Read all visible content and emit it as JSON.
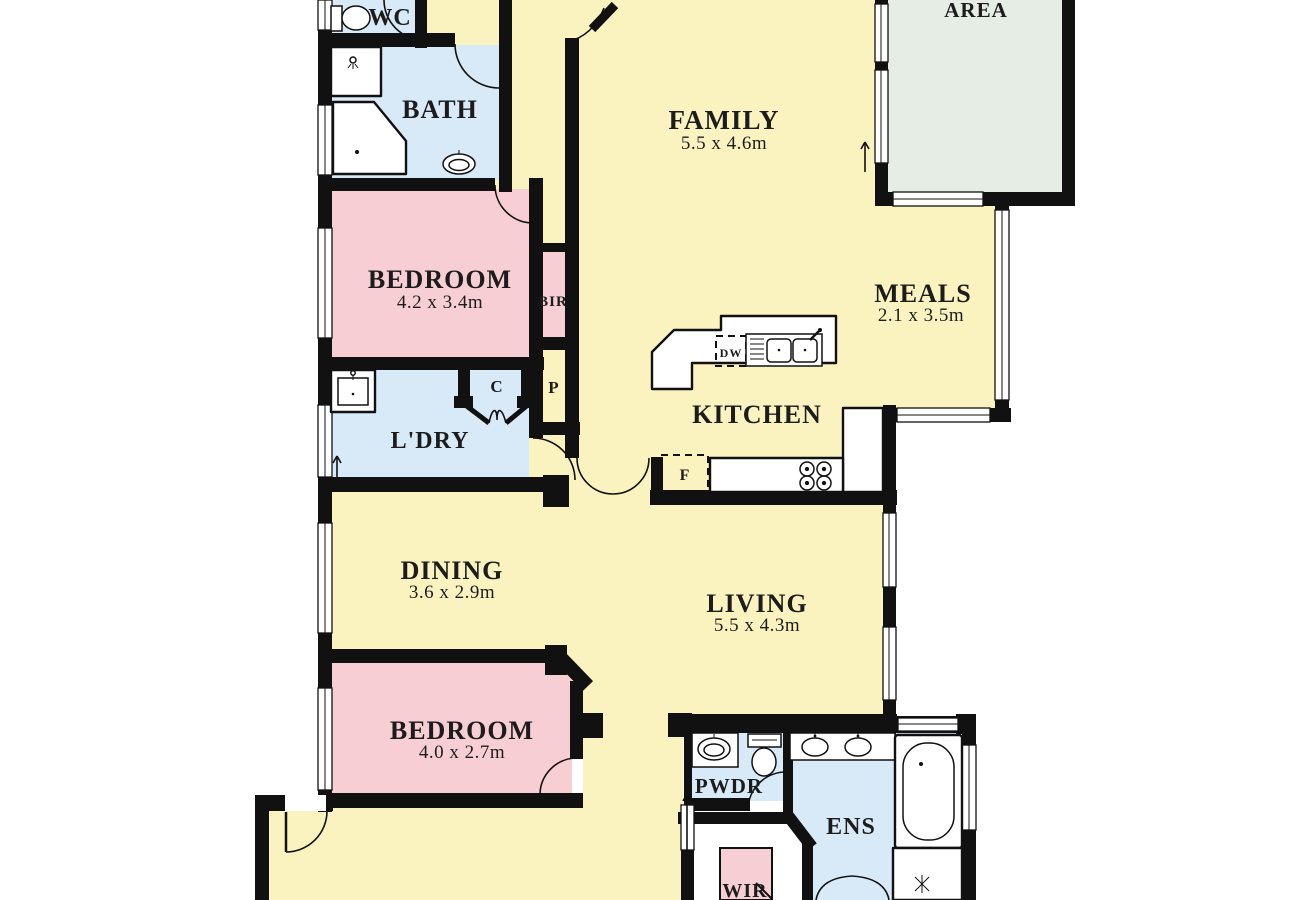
{
  "title": "Residential floor plan",
  "colors": {
    "living_yellow": "#faf3c0",
    "bedroom_pink": "#f7ced3",
    "wet_blue": "#d8e9f8",
    "outdoor_green": "#e5ede5",
    "wall_black": "#111111",
    "text": "#1c1c1c"
  },
  "rooms": {
    "wc": {
      "name": "WC"
    },
    "bath": {
      "name": "BATH"
    },
    "bedroom1": {
      "name": "BEDROOM",
      "dims": "4.2 x 3.4m"
    },
    "bir": {
      "name": "BIR"
    },
    "pantry": {
      "name": "P"
    },
    "cupboard": {
      "name": "C"
    },
    "laundry": {
      "name": "L'DRY"
    },
    "family": {
      "name": "FAMILY",
      "dims": "5.5 x 4.6m"
    },
    "area": {
      "name": "AREA"
    },
    "meals": {
      "name": "MEALS",
      "dims": "2.1 x 3.5m"
    },
    "kitchen": {
      "name": "KITCHEN"
    },
    "dining": {
      "name": "DINING",
      "dims": "3.6 x 2.9m"
    },
    "living": {
      "name": "LIVING",
      "dims": "5.5 x 4.3m"
    },
    "bedroom2": {
      "name": "BEDROOM",
      "dims": "4.0 x 2.7m"
    },
    "pwdr": {
      "name": "PWDR"
    },
    "ens": {
      "name": "ENS"
    },
    "wir": {
      "name": "WIR"
    }
  },
  "appliances": {
    "dishwasher": "DW",
    "fridge": "F"
  }
}
